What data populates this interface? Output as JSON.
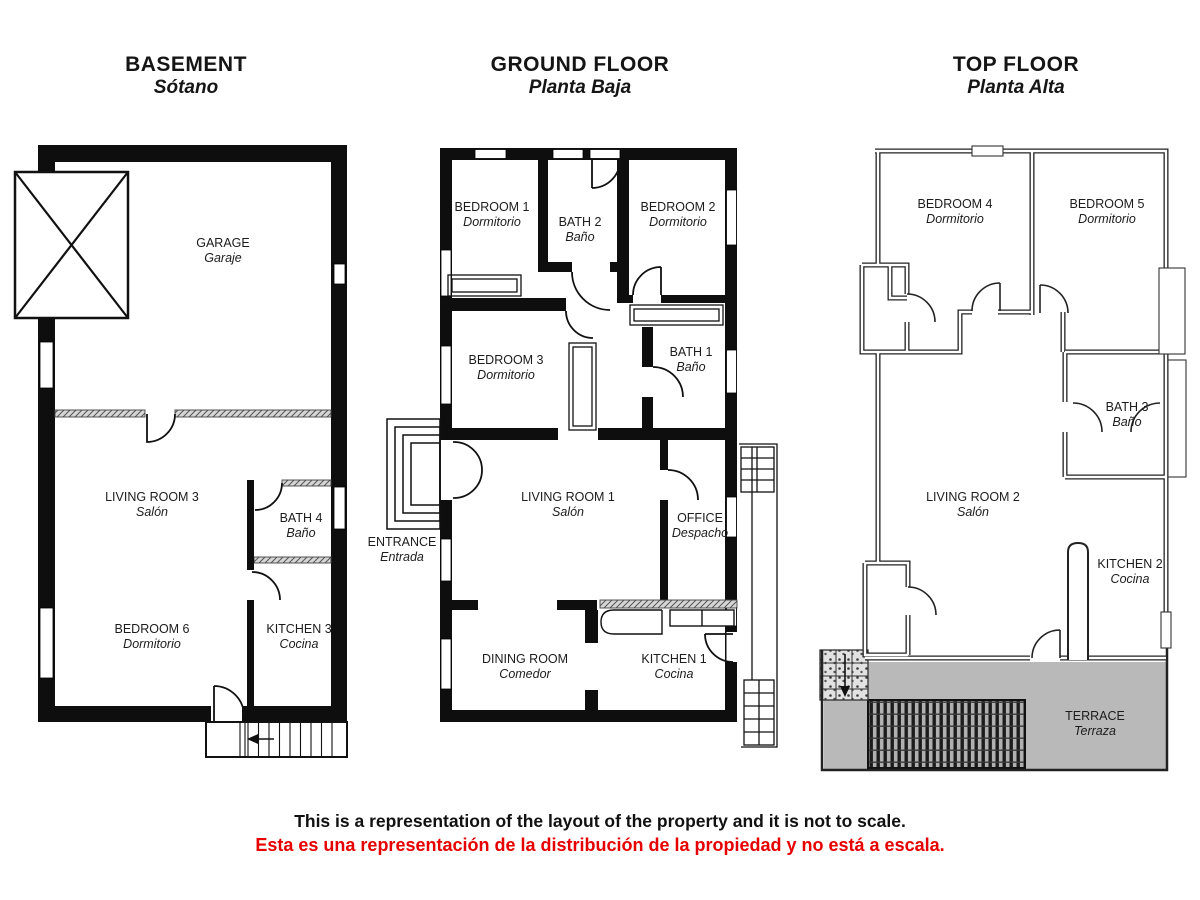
{
  "colors": {
    "wall_black": "#0e0e0e",
    "terrace_gray": "#b9b9b9",
    "disclaimer_red": "#e60000"
  },
  "disclaimer": {
    "en": "This is a representation of the layout of the property and it is not to scale.",
    "es": "Esta es una representación de la distribución de la propiedad y no está a escala."
  },
  "floors": [
    {
      "title": "BASEMENT",
      "subtitle": "Sótano",
      "rooms": [
        {
          "name": "GARAGE",
          "name_es": "Garaje"
        },
        {
          "name": "LIVING ROOM 3",
          "name_es": "Salón"
        },
        {
          "name": "BATH 4",
          "name_es": "Baño"
        },
        {
          "name": "BEDROOM 6",
          "name_es": "Dormitorio"
        },
        {
          "name": "KITCHEN 3",
          "name_es": "Cocina"
        }
      ]
    },
    {
      "title": "GROUND FLOOR",
      "subtitle": "Planta Baja",
      "rooms": [
        {
          "name": "BEDROOM 1",
          "name_es": "Dormitorio"
        },
        {
          "name": "BATH 2",
          "name_es": "Baño"
        },
        {
          "name": "BEDROOM 2",
          "name_es": "Dormitorio"
        },
        {
          "name": "BEDROOM 3",
          "name_es": "Dormitorio"
        },
        {
          "name": "BATH 1",
          "name_es": "Baño"
        },
        {
          "name": "LIVING ROOM 1",
          "name_es": "Salón"
        },
        {
          "name": "OFFICE",
          "name_es": "Despacho"
        },
        {
          "name": "ENTRANCE",
          "name_es": "Entrada"
        },
        {
          "name": "DINING ROOM",
          "name_es": "Comedor"
        },
        {
          "name": "KITCHEN 1",
          "name_es": "Cocina"
        }
      ]
    },
    {
      "title": "TOP FLOOR",
      "subtitle": "Planta Alta",
      "rooms": [
        {
          "name": "BEDROOM 4",
          "name_es": "Dormitorio"
        },
        {
          "name": "BEDROOM 5",
          "name_es": "Dormitorio"
        },
        {
          "name": "BATH 3",
          "name_es": "Baño"
        },
        {
          "name": "LIVING ROOM 2",
          "name_es": "Salón"
        },
        {
          "name": "KITCHEN  2",
          "name_es": "Cocina"
        },
        {
          "name": "TERRACE",
          "name_es": "Terraza"
        }
      ]
    }
  ]
}
